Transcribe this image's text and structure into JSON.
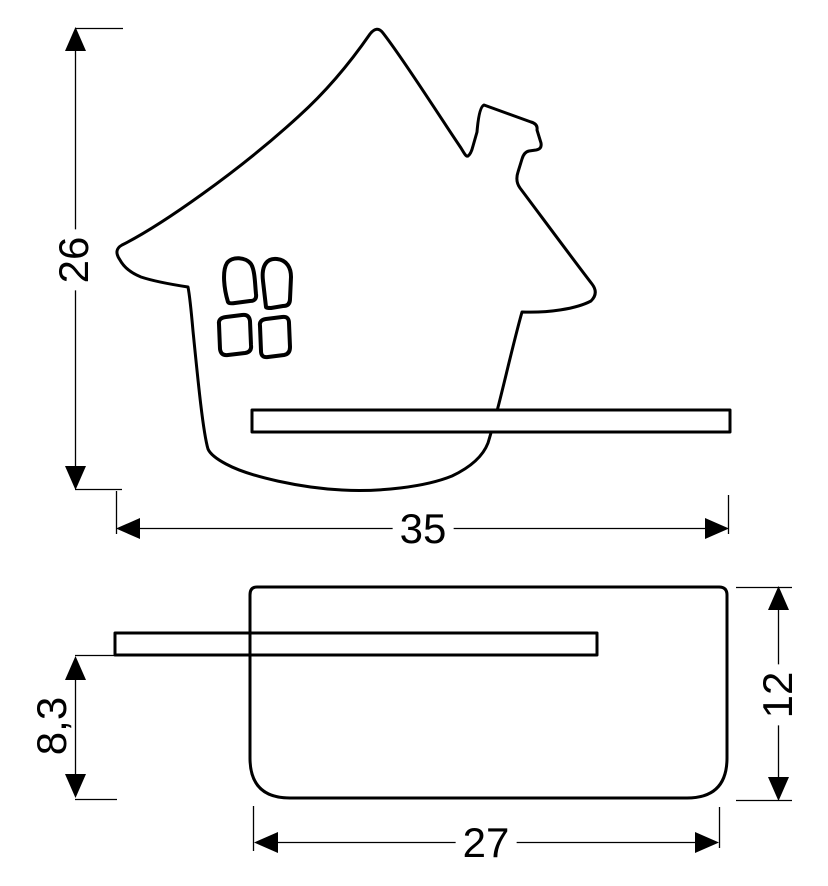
{
  "colors": {
    "ink": "#000000",
    "paper": "#ffffff"
  },
  "drawing": {
    "dimensions": {
      "front_height": "26",
      "front_width": "35",
      "side_shelf_height": "8,3",
      "side_depth": "12",
      "side_base_width": "27"
    }
  }
}
